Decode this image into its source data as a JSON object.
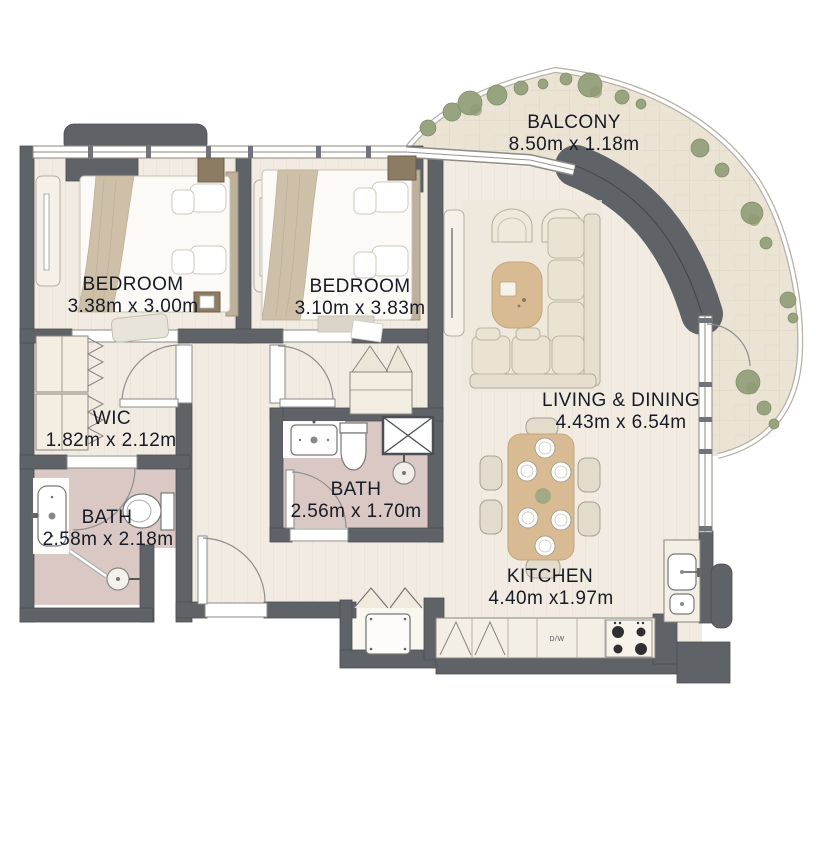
{
  "plan_title": "2 Bedroom Apartment Floor Plan",
  "rooms": [
    {
      "id": "balcony",
      "name": "BALCONY",
      "dims": "8.50m x 1.18m"
    },
    {
      "id": "bedroom-1",
      "name": "BEDROOM",
      "dims": "3.38m x 3.00m"
    },
    {
      "id": "bedroom-2",
      "name": "BEDROOM",
      "dims": "3.10m x 3.83m"
    },
    {
      "id": "living-dining",
      "name": "LIVING & DINING",
      "dims": "4.43m x 6.54m"
    },
    {
      "id": "wic",
      "name": "WIC",
      "dims": "1.82m x 2.12m"
    },
    {
      "id": "bath-1",
      "name": "BATH",
      "dims": "2.58m x 2.18m"
    },
    {
      "id": "bath-2",
      "name": "BATH",
      "dims": "2.56m x 1.70m"
    },
    {
      "id": "kitchen",
      "name": "KITCHEN",
      "dims": "4.40m x1.97m"
    }
  ],
  "appliances": {
    "dishwasher_label": "D/W"
  },
  "colors": {
    "wall": "#5f6367",
    "floor": "#f2ebe1",
    "bath_floor": "#d9c8c4",
    "balcony_floor": "#ebe3d4",
    "plant": "#98a47f",
    "label_text": "#161b26",
    "wood_furniture": "#d9bb93"
  }
}
